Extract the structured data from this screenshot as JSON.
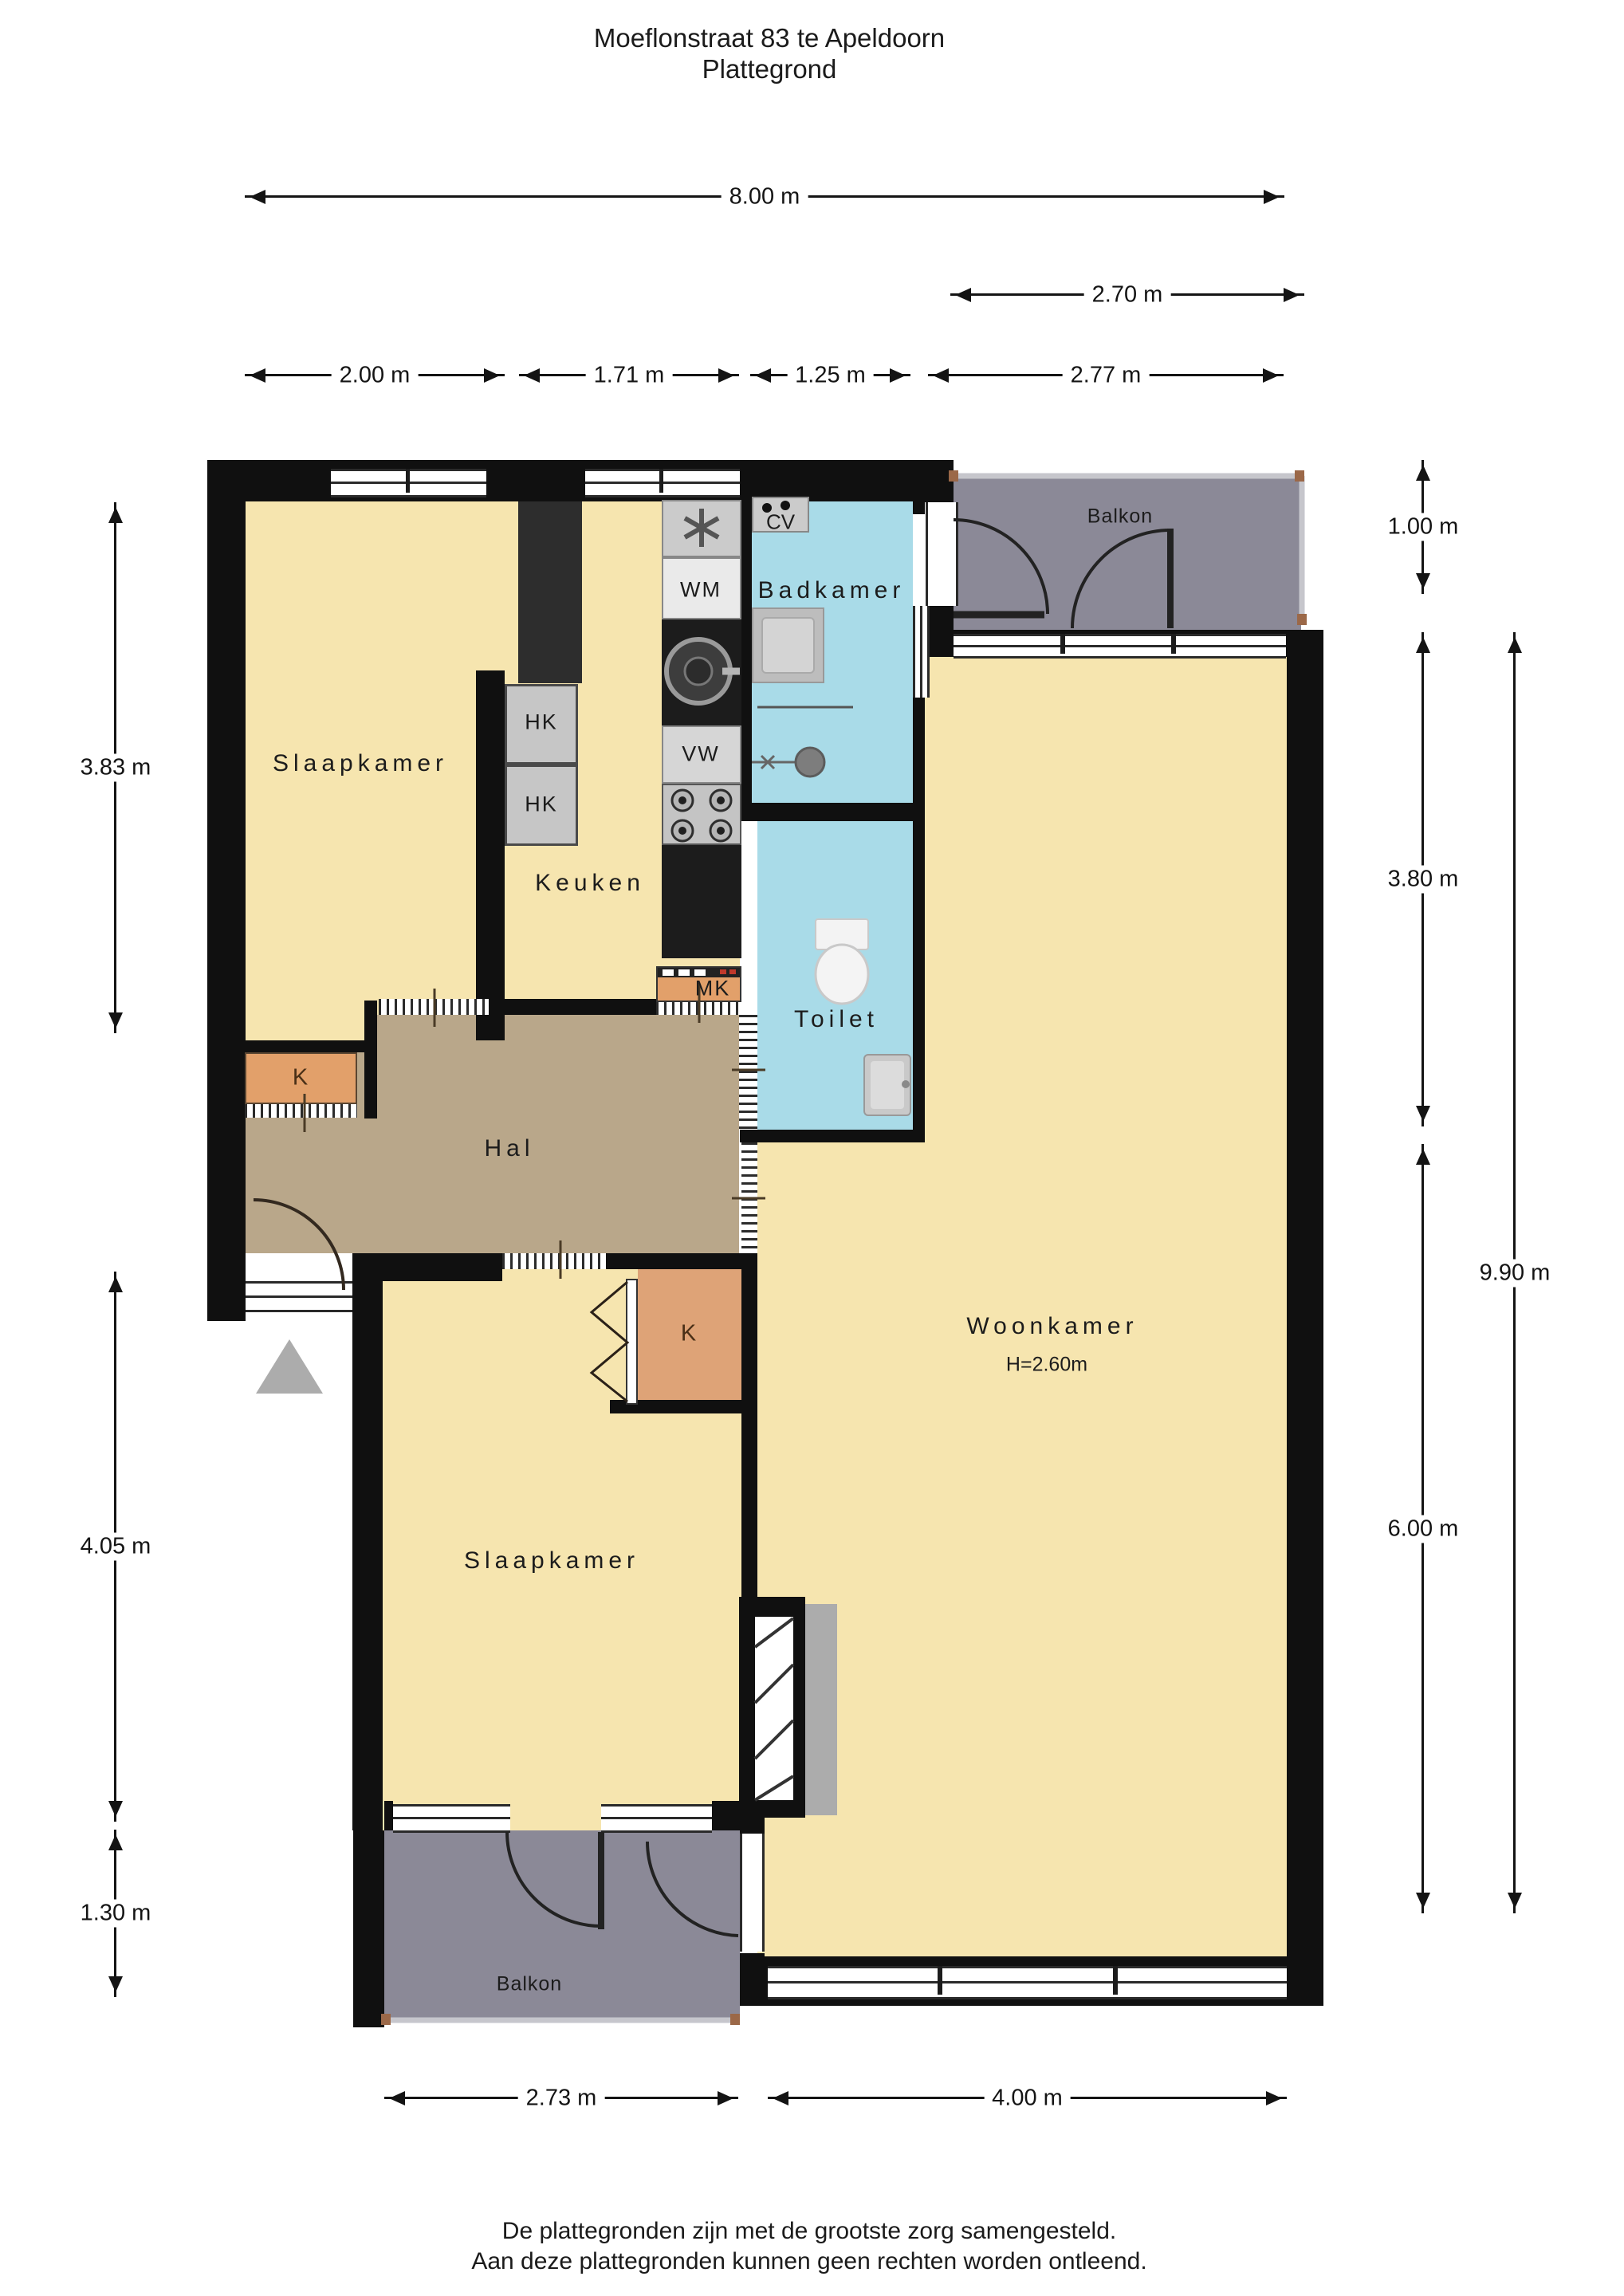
{
  "title": {
    "line1": "Moeflonstraat 83 te Apeldoorn",
    "line2": "Plattegrond"
  },
  "rooms": {
    "slaapkamer_top": "Slaapkamer",
    "keuken": "Keuken",
    "badkamer": "Badkamer",
    "toilet": "Toilet",
    "hal": "Hal",
    "woonkamer": "Woonkamer",
    "woonkamer_ceiling_height": "H=2.60m",
    "slaapkamer_bottom": "Slaapkamer",
    "balkon_top": "Balkon",
    "balkon_bottom": "Balkon"
  },
  "fixtures": {
    "wasmachine": "WM",
    "vaatwasser": "VW",
    "cv_ketel": "CV",
    "meterkast": "MK",
    "hangkast_1": "HK",
    "hangkast_2": "HK",
    "kast_hal": "K",
    "kast_slaapkamer": "K"
  },
  "dimensions": {
    "top_total": "8.00 m",
    "balkon_top_width": "2.70 m",
    "slaapkamer_top_width": "2.00 m",
    "keuken_width": "1.71 m",
    "badkamer_width": "1.25 m",
    "woonkamer_width": "2.77 m",
    "left_slaapkamer_top": "3.83 m",
    "left_slaapkamer_bottom": "4.05 m",
    "left_balkon": "1.30 m",
    "right_balkon_depth": "1.00 m",
    "right_upper": "3.80 m",
    "right_lower": "6.00 m",
    "right_total": "9.90 m",
    "bottom_slaapkamer": "2.73 m",
    "bottom_woonkamer": "4.00 m"
  },
  "footer": {
    "line1": "De plattegronden zijn met de grootste zorg samengesteld.",
    "line2": "Aan deze plattegronden kunnen geen rechten worden ontleend."
  },
  "colors": {
    "room_yellow": "#F6E5AF",
    "hal_tan": "#B9A78A",
    "wet_room_blue": "#A9DBE8",
    "balcony_gray": "#8B8997",
    "closet_orange": "#E2A06A",
    "cabinet_gray": "#C6C6C6",
    "wall_black": "#101010"
  }
}
